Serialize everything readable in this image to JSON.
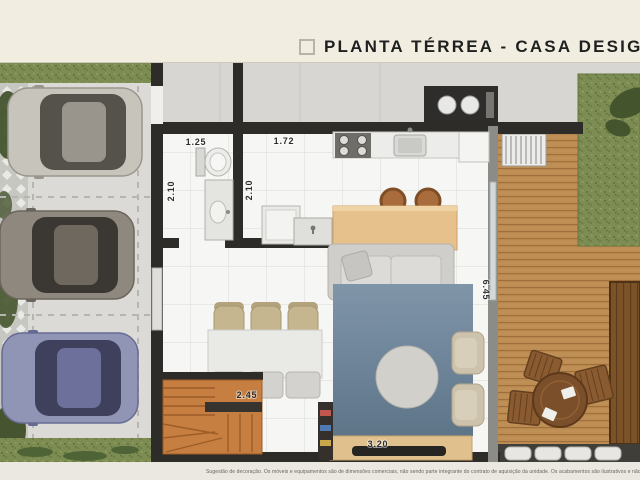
{
  "header": {
    "title": "PLANTA TÉRREA - CASA DESIGN"
  },
  "plan": {
    "dimensions": {
      "bathroom_width": "1.25",
      "laundry_width": "1.72",
      "bathroom_depth": "2.10",
      "laundry_depth": "2.10",
      "dining_table_width": "2.45",
      "living_width": "3.20",
      "living_depth": "6.45"
    }
  },
  "footer": {
    "disclaimer": "Sugestão de decoração. Os móveis e equipamentos são de dimensões comerciais, não sendo parte integrante do contrato de aquisição da unidade. Os acabamentos são ilustrativos e não"
  },
  "palette": {
    "wall": "#2e2c29",
    "deck_wood": "#bd8d53",
    "stairs_wood": "#c67f40",
    "rug_blue": "#6d8398",
    "grass": "#7d8c52",
    "banner_cream": "#f1eee1"
  }
}
